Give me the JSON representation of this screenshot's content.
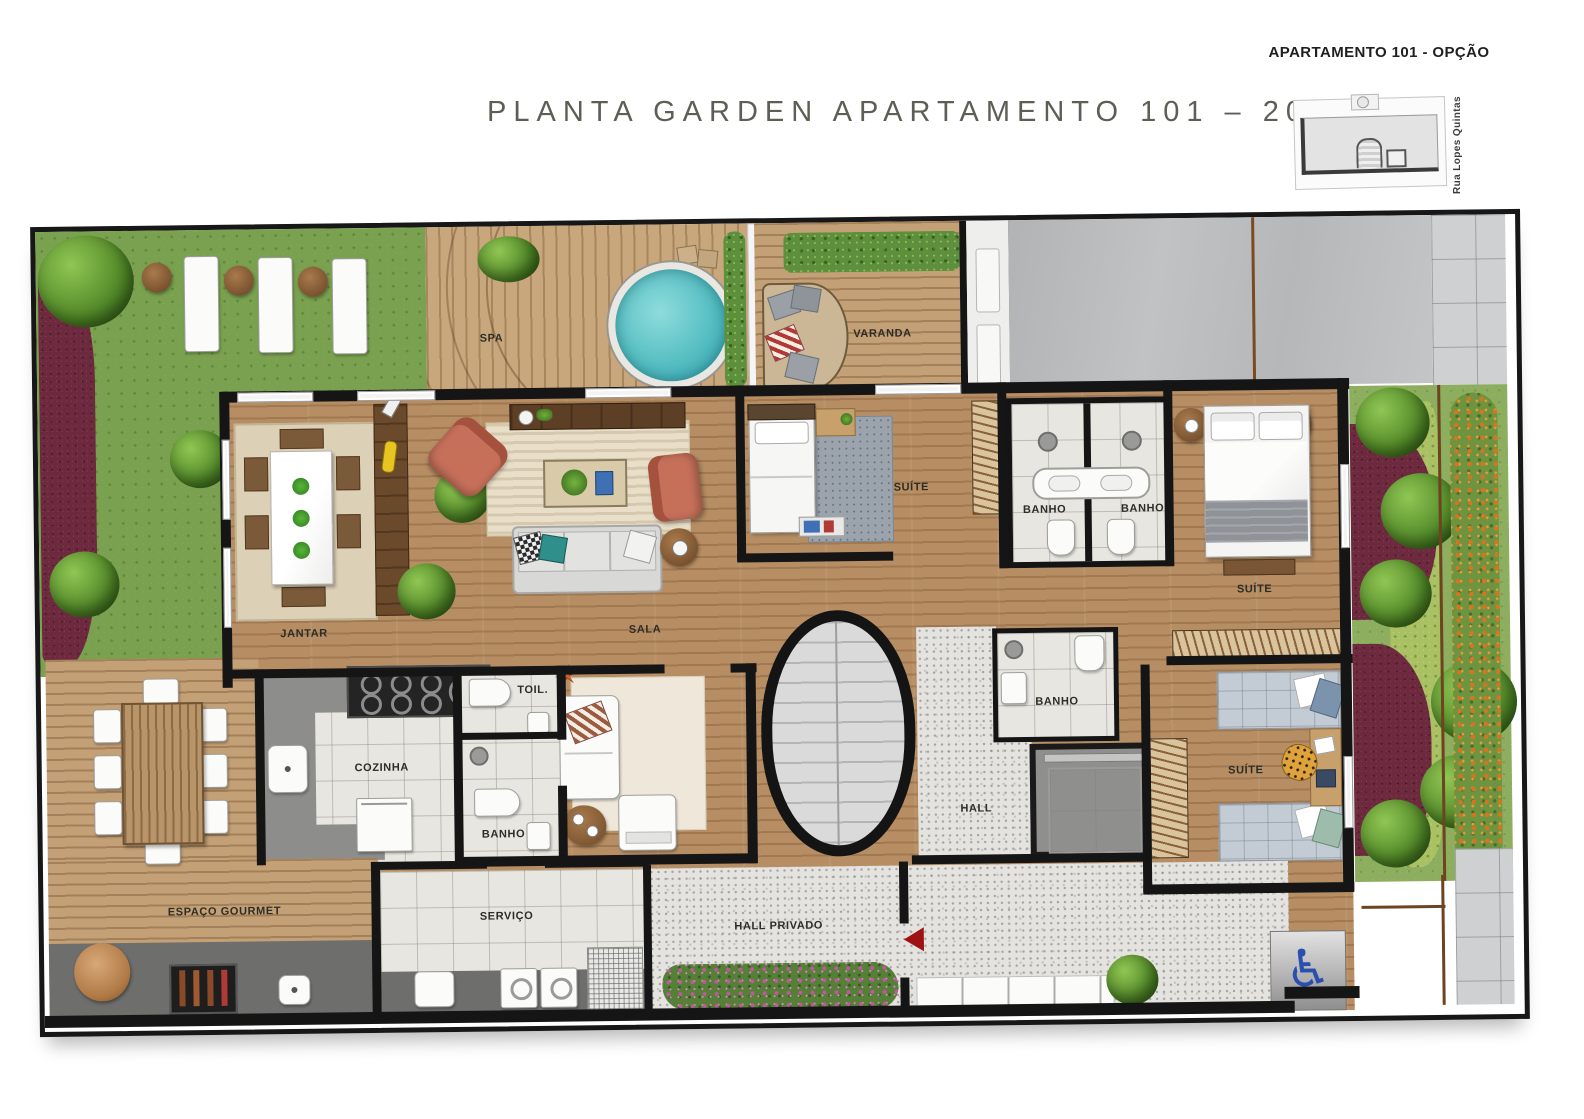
{
  "header": {
    "title_main": "PLANTA GARDEN APARTAMENTO 101 – 207,19M",
    "title_sup": "2"
  },
  "keyplan": {
    "title": "APARTAMENTO 101 - OPÇÃO",
    "street": "Rua Lopes Quintas"
  },
  "rooms": {
    "spa": "SPA",
    "varanda": "VARANDA",
    "jantar": "JANTAR",
    "sala": "SALA",
    "suite_top": "SUÍTE",
    "banho_top_left": "BANHO",
    "banho_top_right": "BANHO",
    "suite_master": "SUÍTE",
    "cozinha": "COZINHA",
    "toil": "TOIL.",
    "banho_social": "BANHO",
    "banho_hall": "BANHO",
    "hall": "HALL",
    "suite_bottom": "SUÍTE",
    "espaco_gourmet": "ESPAÇO GOURMET",
    "servico": "SERVIÇO",
    "hall_privado": "HALL PRIVADO"
  },
  "colors": {
    "pool": "#62c4c6",
    "wall": "#151515",
    "grass": "#7aa14f",
    "flowerbed_purple": "#6d2a3f",
    "orange_flowers": "#d8741f",
    "armchair_coral": "#c6705a",
    "accessible_blue": "#2a4fae"
  }
}
